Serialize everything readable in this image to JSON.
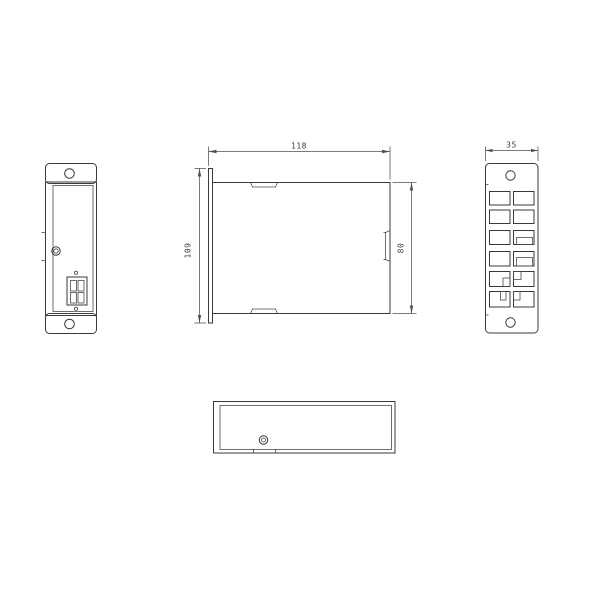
{
  "drawing": {
    "colors": {
      "background": "#ffffff",
      "outline": "#3a3a3a",
      "dimension_line": "#4f4f4f",
      "dimension_text": "#3f3f3f"
    },
    "dimensions": {
      "front_width": "118",
      "mount_flange_height": "109",
      "body_height": "80",
      "side_panel_width": "35"
    }
  }
}
